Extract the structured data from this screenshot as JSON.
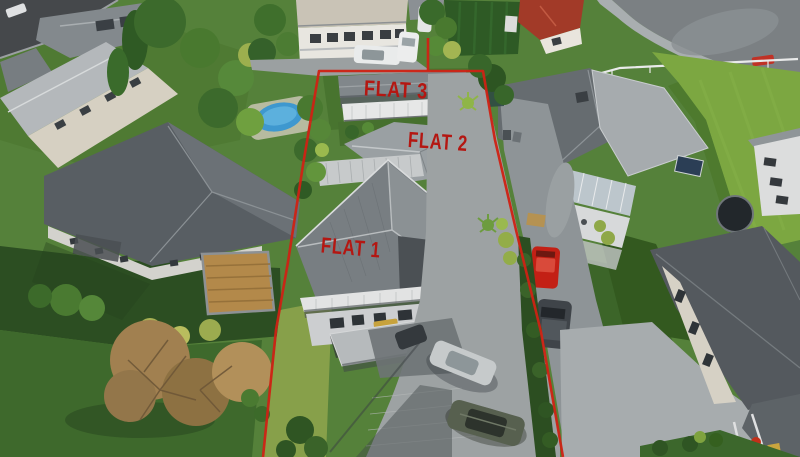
{
  "meta": {
    "type": "aerial-drone-photograph",
    "description": "Aerial real-estate photo of a residential section containing three flats, outlined with a red boundary line, surrounded by neighbouring houses, driveways, lawns and trees"
  },
  "annotations": {
    "boundary_color": "#cf2214",
    "label_color": "#b41712",
    "labels": [
      {
        "id": "flat-1",
        "text": "FLAT 1"
      },
      {
        "id": "flat-2",
        "text": "FLAT 2"
      },
      {
        "id": "flat-3",
        "text": "FLAT 3"
      }
    ]
  },
  "scene": {
    "palette": {
      "grass": "#55813a",
      "sunlit_field": "#7ca741",
      "shadow_lawn": "#2c4e22",
      "roof_dark_grey": "#585e63",
      "roof_mid_grey": "#7e8487",
      "roof_light_grey": "#b4b8bb",
      "concrete": "#9da2a3",
      "asphalt": "#45484b",
      "pool_blue": "#3e98cf",
      "red_car": "#c32015",
      "red_roof": "#a23a28",
      "autumn_tree": "#a18050"
    },
    "objects": [
      "flat-1-house",
      "flat-2-house",
      "flat-3-house",
      "shared-driveway",
      "property-boundary",
      "swimming-pool",
      "trampoline",
      "red-hatchback",
      "dark-suv",
      "silver-sedan",
      "green-suv",
      "white-sedan",
      "white-van",
      "autumn-trees",
      "neighbour-houses",
      "street",
      "paddock-fence"
    ]
  }
}
